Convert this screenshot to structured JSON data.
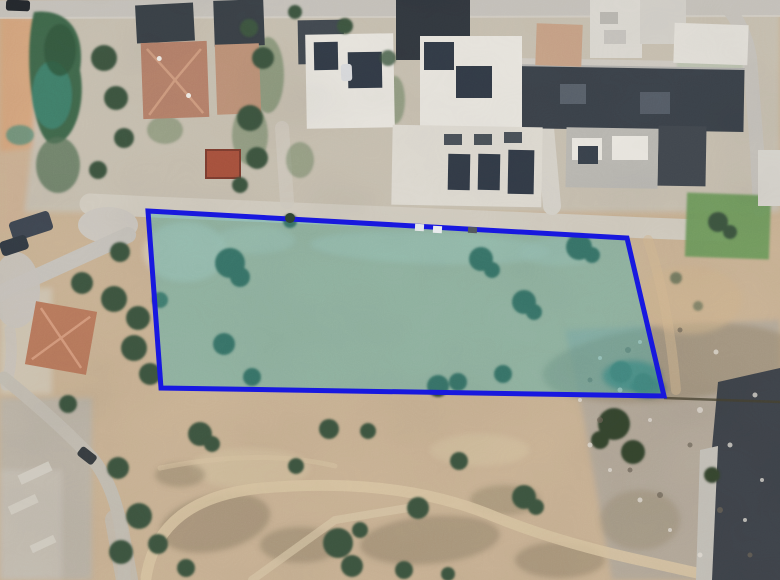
{
  "parcel": {
    "points": "148,211 627,238 664,396 161,388",
    "fill": "rgba(70,178,175,0.44)",
    "stroke": "#1717e3",
    "stroke_width": "5"
  },
  "palette": {
    "ground": "#c9b294",
    "upper_ground": "#c7bfb0",
    "orange_dirt": "#d4a57e",
    "road": "#c6c2bb",
    "road_light": "#d2ccc0",
    "dirt_path": "#d8c4a2",
    "rubble": "#b3a899",
    "scrub": "#8f8066",
    "vegetation": "#41684b",
    "tree": "#3c5540",
    "teal_brush": "#3f8573",
    "lawn": "#6f9a5d",
    "dark_roof": "#3a4147",
    "white_roof": "#e8e5de",
    "terracotta_roof": "#b5816a",
    "dark_building": "#3e434a",
    "fence_line": "#46402f"
  }
}
